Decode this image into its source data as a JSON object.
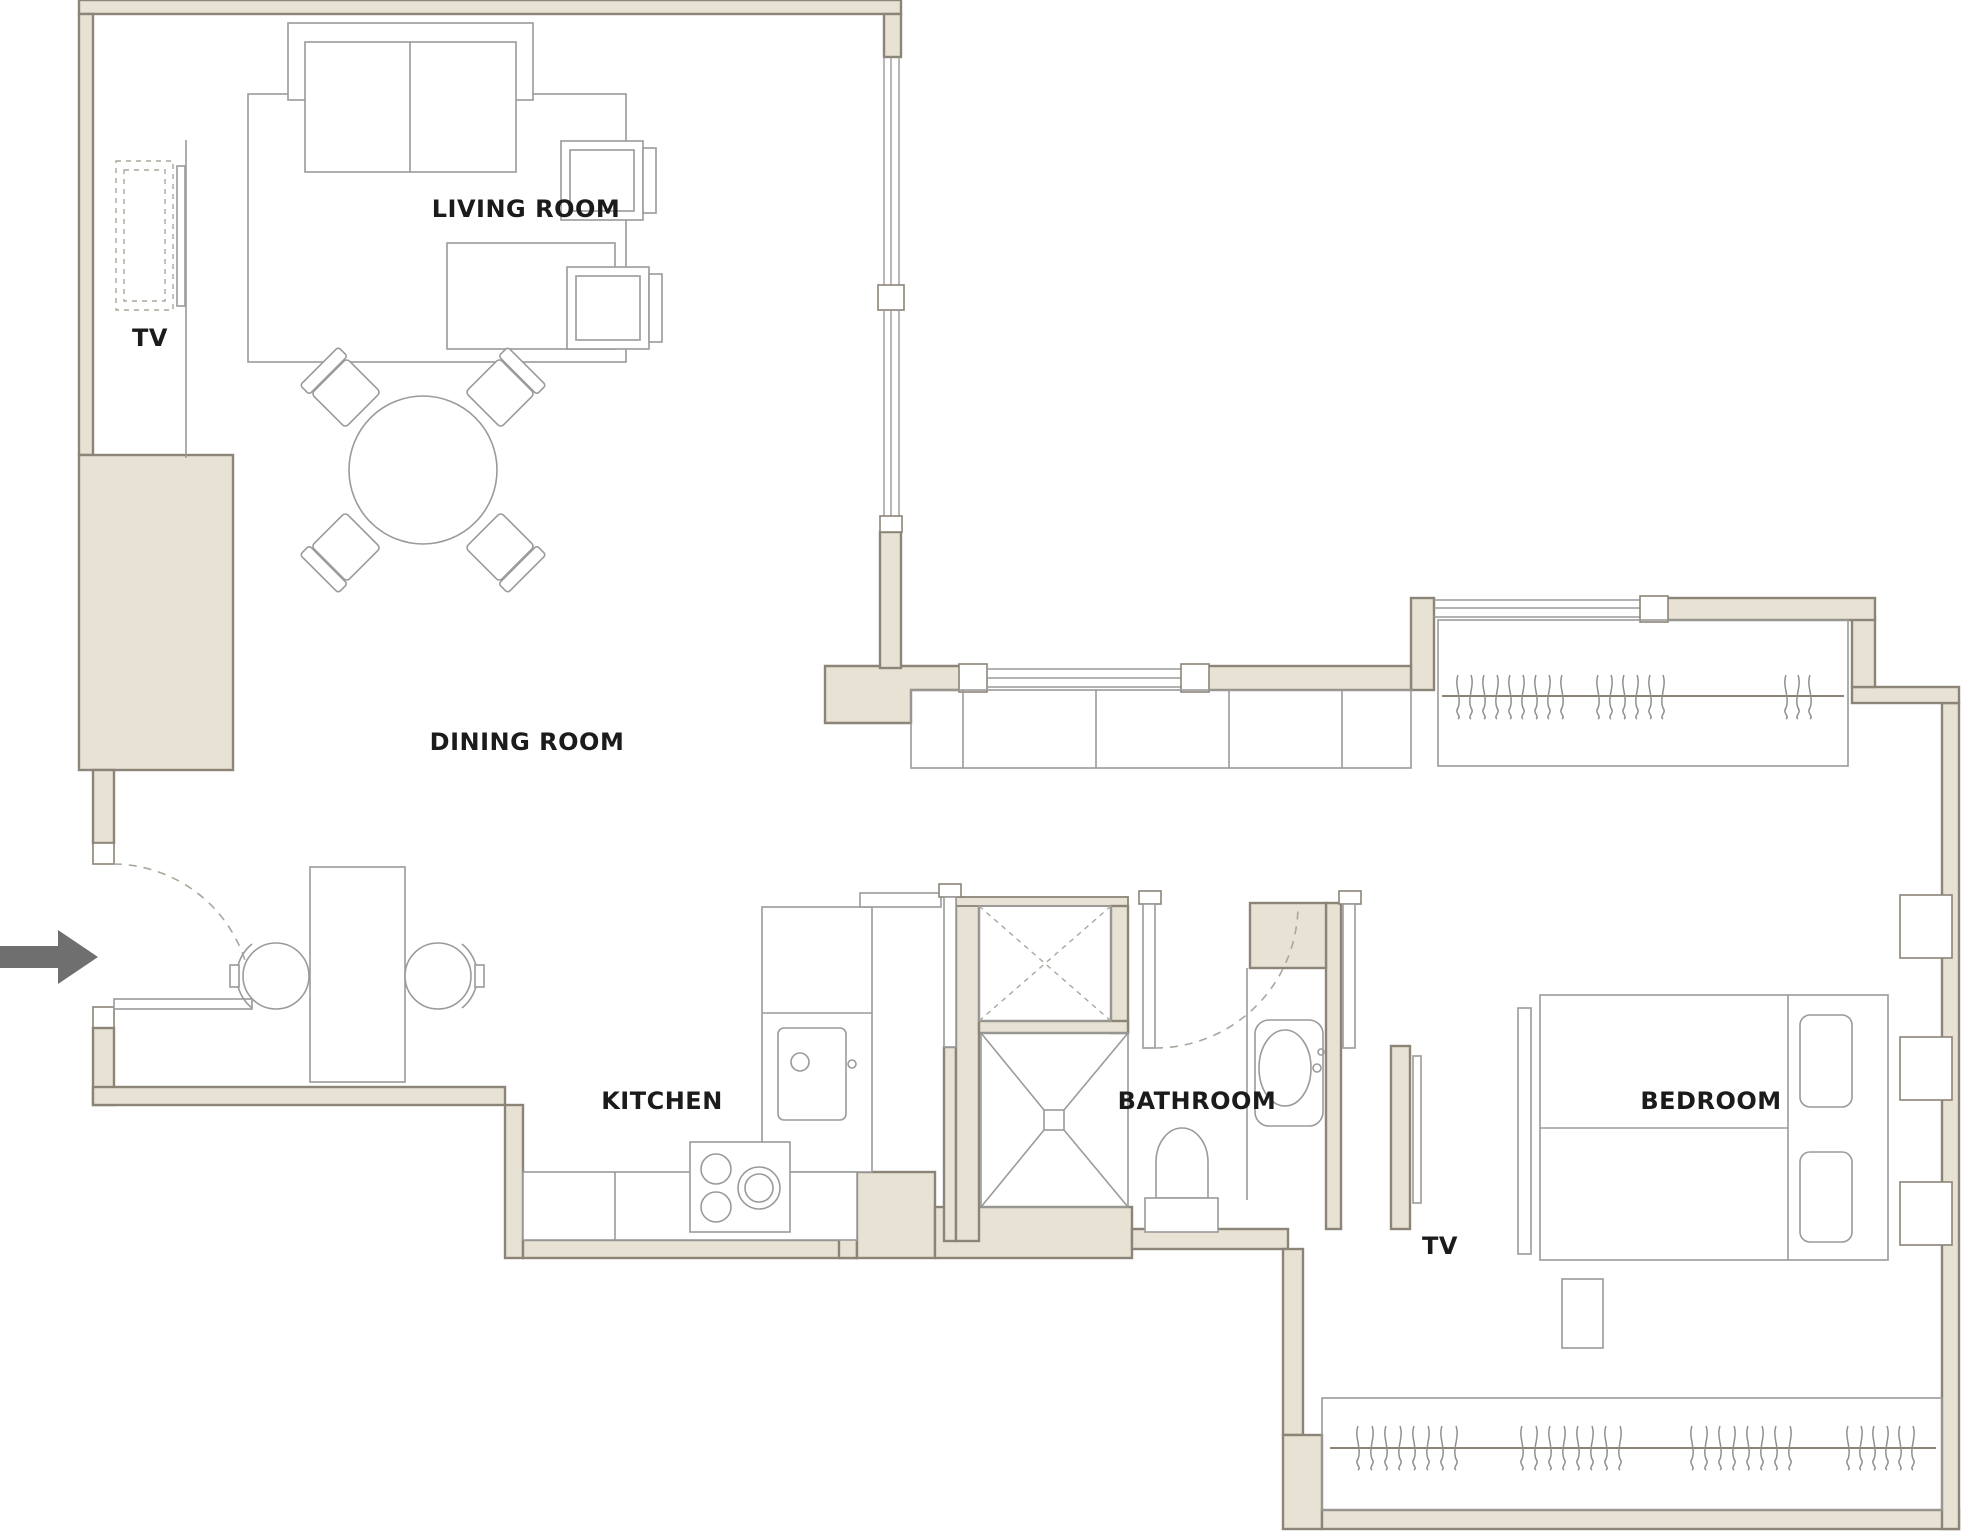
{
  "labels": {
    "living_room": "LIVING ROOM",
    "tv_living": "TV",
    "dining_room": "DINING ROOM",
    "kitchen": "KITCHEN",
    "bathroom": "BATHROOM",
    "tv_bedroom": "TV",
    "bedroom": "BEDROOM"
  },
  "colors": {
    "wall_fill": "#e8e2d4",
    "wall_stroke": "#8b8477",
    "line": "#9a9a9a",
    "dashed": "#aaa69c",
    "text": "#1b1b1b",
    "arrow": "#6f6f6f",
    "background": "#ffffff"
  }
}
